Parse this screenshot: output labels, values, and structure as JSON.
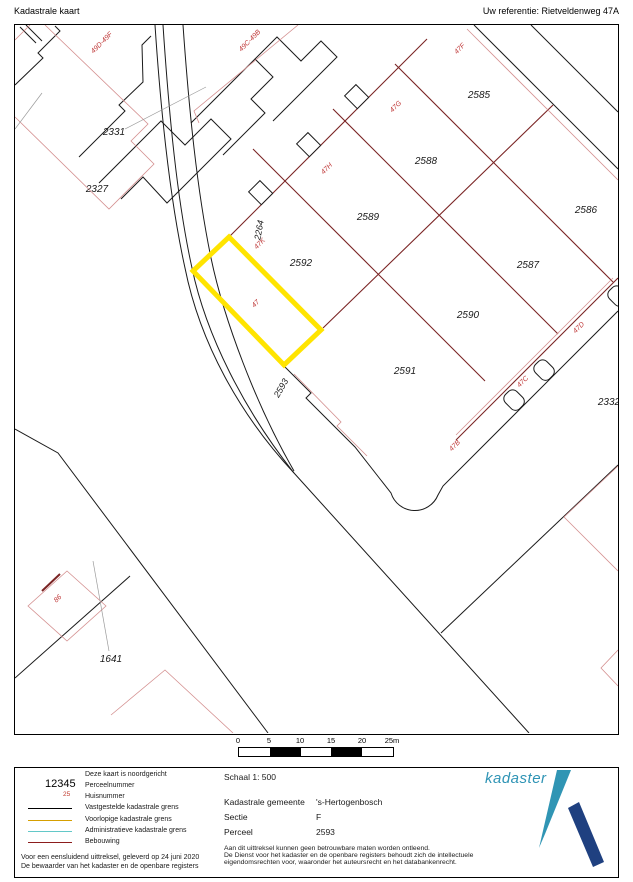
{
  "header": {
    "title": "Kadastrale kaart",
    "reference": "Uw referentie: Rietveldenweg 47A"
  },
  "map": {
    "highlight_color": "#ffe400",
    "boundary_color": "#000000",
    "building_color": "#7a2424",
    "provisional_color": "#d69f00",
    "administrative_color": "#63c8c8",
    "parcels": [
      "2331",
      "2327",
      "2592",
      "2589",
      "2588",
      "2585",
      "2586",
      "2587",
      "2590",
      "2591",
      "2332",
      "1641"
    ],
    "roads": [
      "2264",
      "2593"
    ],
    "house_numbers": [
      "49D-49F",
      "49C-49B",
      "47F",
      "47G",
      "47H",
      "47K",
      "47",
      "47D",
      "47C",
      "47B",
      "86"
    ]
  },
  "scale_bar": {
    "ticks": [
      "0",
      "5",
      "10",
      "15",
      "20",
      "25m"
    ]
  },
  "legend": {
    "example_parcel": "12345",
    "example_house": "25",
    "north_note": "Deze kaart is noordgericht",
    "items": [
      "Perceelnummer",
      "Huisnummer",
      "Vastgestelde kadastrale grens",
      "Voorlopige kadastrale grens",
      "Administratieve kadastrale grens",
      "Bebouwing"
    ],
    "footnote1": "Voor een eensluidend uittreksel, geleverd op 24 juni 2020",
    "footnote2": "De bewaarder van het kadaster en de openbare registers"
  },
  "info": {
    "scale": "Schaal 1: 500",
    "rows": [
      {
        "label": "Kadastrale gemeente",
        "value": "'s-Hertogenbosch"
      },
      {
        "label": "Sectie",
        "value": "F"
      },
      {
        "label": "Perceel",
        "value": "2593"
      }
    ],
    "disclaimer1": "Aan dit uittreksel kunnen geen betrouwbare maten worden ontleend.",
    "disclaimer2": "De Dienst voor het kadaster en de openbare registers behoudt zich de intellectuele",
    "disclaimer3": "eigendomsrechten voor, waaronder het auteursrecht en het databankenrecht.",
    "brand": "kadaster"
  }
}
